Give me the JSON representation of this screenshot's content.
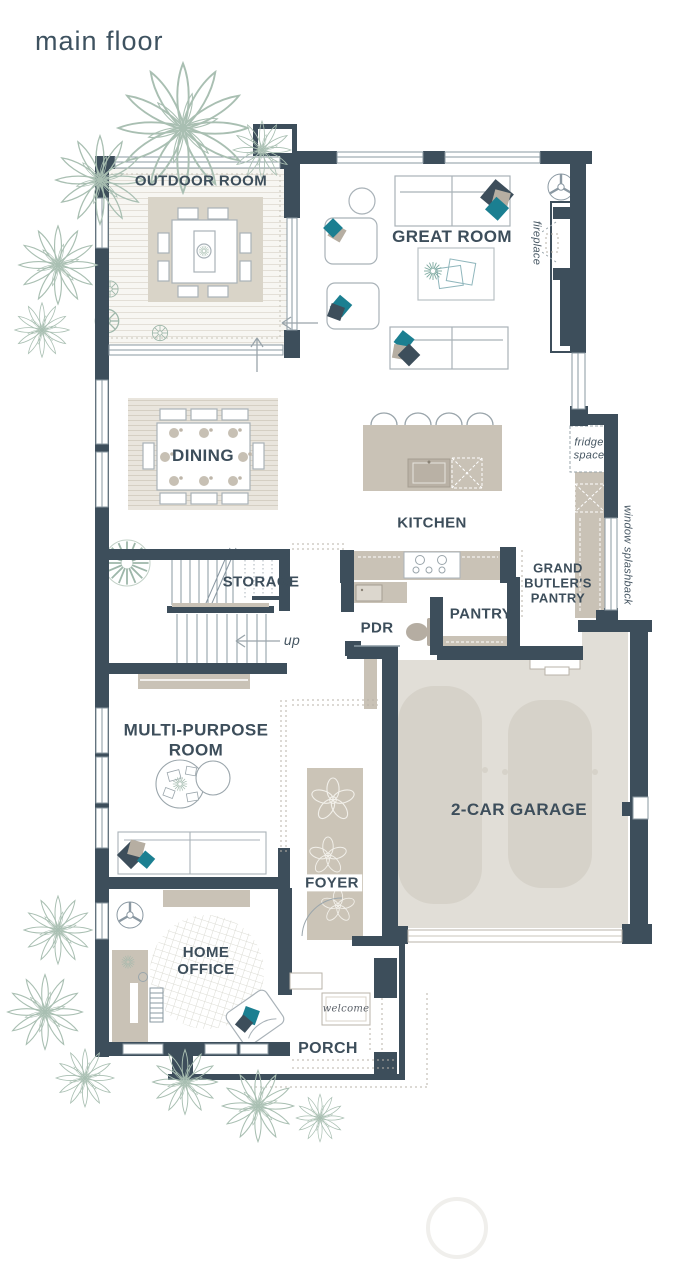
{
  "title": "main floor",
  "rooms": {
    "outdoor_room": "OUTDOOR ROOM",
    "great_room": "GREAT ROOM",
    "dining": "DINING",
    "kitchen": "KITCHEN",
    "storage": "STORAGE",
    "pdr": "PDR",
    "pantry": "PANTRY",
    "grand_butlers_pantry": "GRAND BUTLER'S PANTRY",
    "multi_purpose_room": "MULTI-PURPOSE ROOM",
    "garage": "2-CAR GARAGE",
    "foyer": "FOYER",
    "home_office": "HOME OFFICE",
    "porch": "PORCH"
  },
  "annotations": {
    "fireplace": "fireplace",
    "fridge_space": "fridge space",
    "window_splashback": "window splashback",
    "up": "up",
    "welcome": "welcome"
  },
  "colors": {
    "wall": "#3d4e5b",
    "accent_teal": "#1b7f91",
    "furniture_beige": "#c9c2b6",
    "floor_beige": "#e1ded7",
    "plant_sage": "#a9bfb2",
    "label_text": "#3d4e5b"
  },
  "icons": {
    "ceiling_fan": "fan-icon",
    "plant": "plant-icon",
    "stairs_direction": "up-arrow-icon",
    "entry_direction": "entry-arrow-icon"
  }
}
